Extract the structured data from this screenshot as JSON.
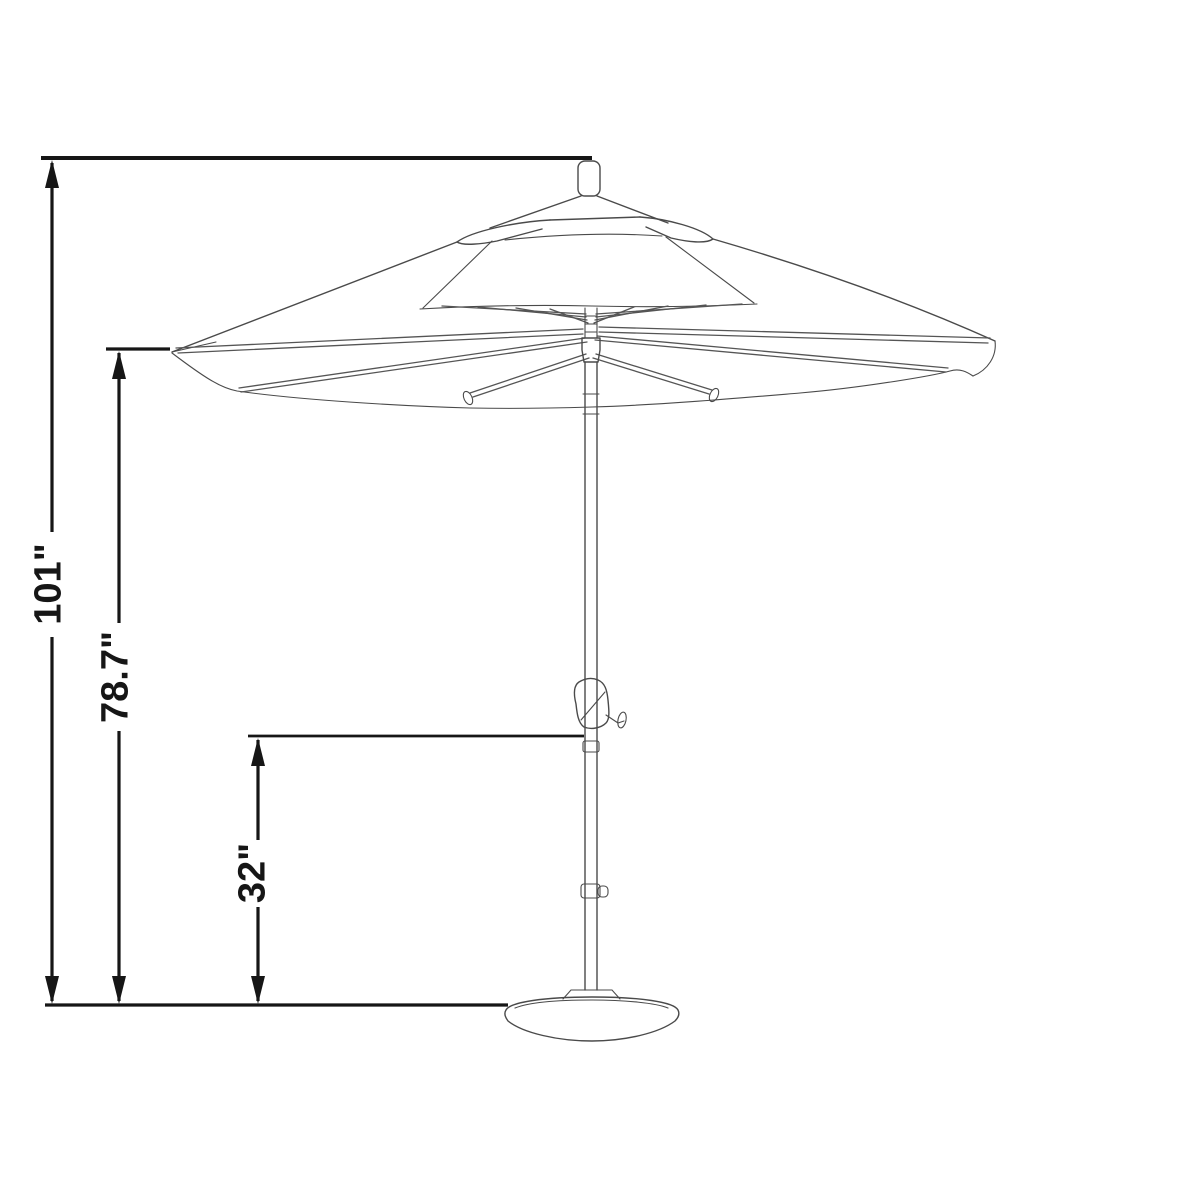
{
  "diagram": {
    "kind": "umbrella-dimension-drawing",
    "colors": {
      "dimension": "#161616",
      "drawing": "#4a4a4a",
      "bg": "#ffffff"
    },
    "dimensions": {
      "overall_height": {
        "label": "101\""
      },
      "canopy_clearance": {
        "label": "78.7\""
      },
      "crank_height": {
        "label": "32\""
      }
    }
  }
}
